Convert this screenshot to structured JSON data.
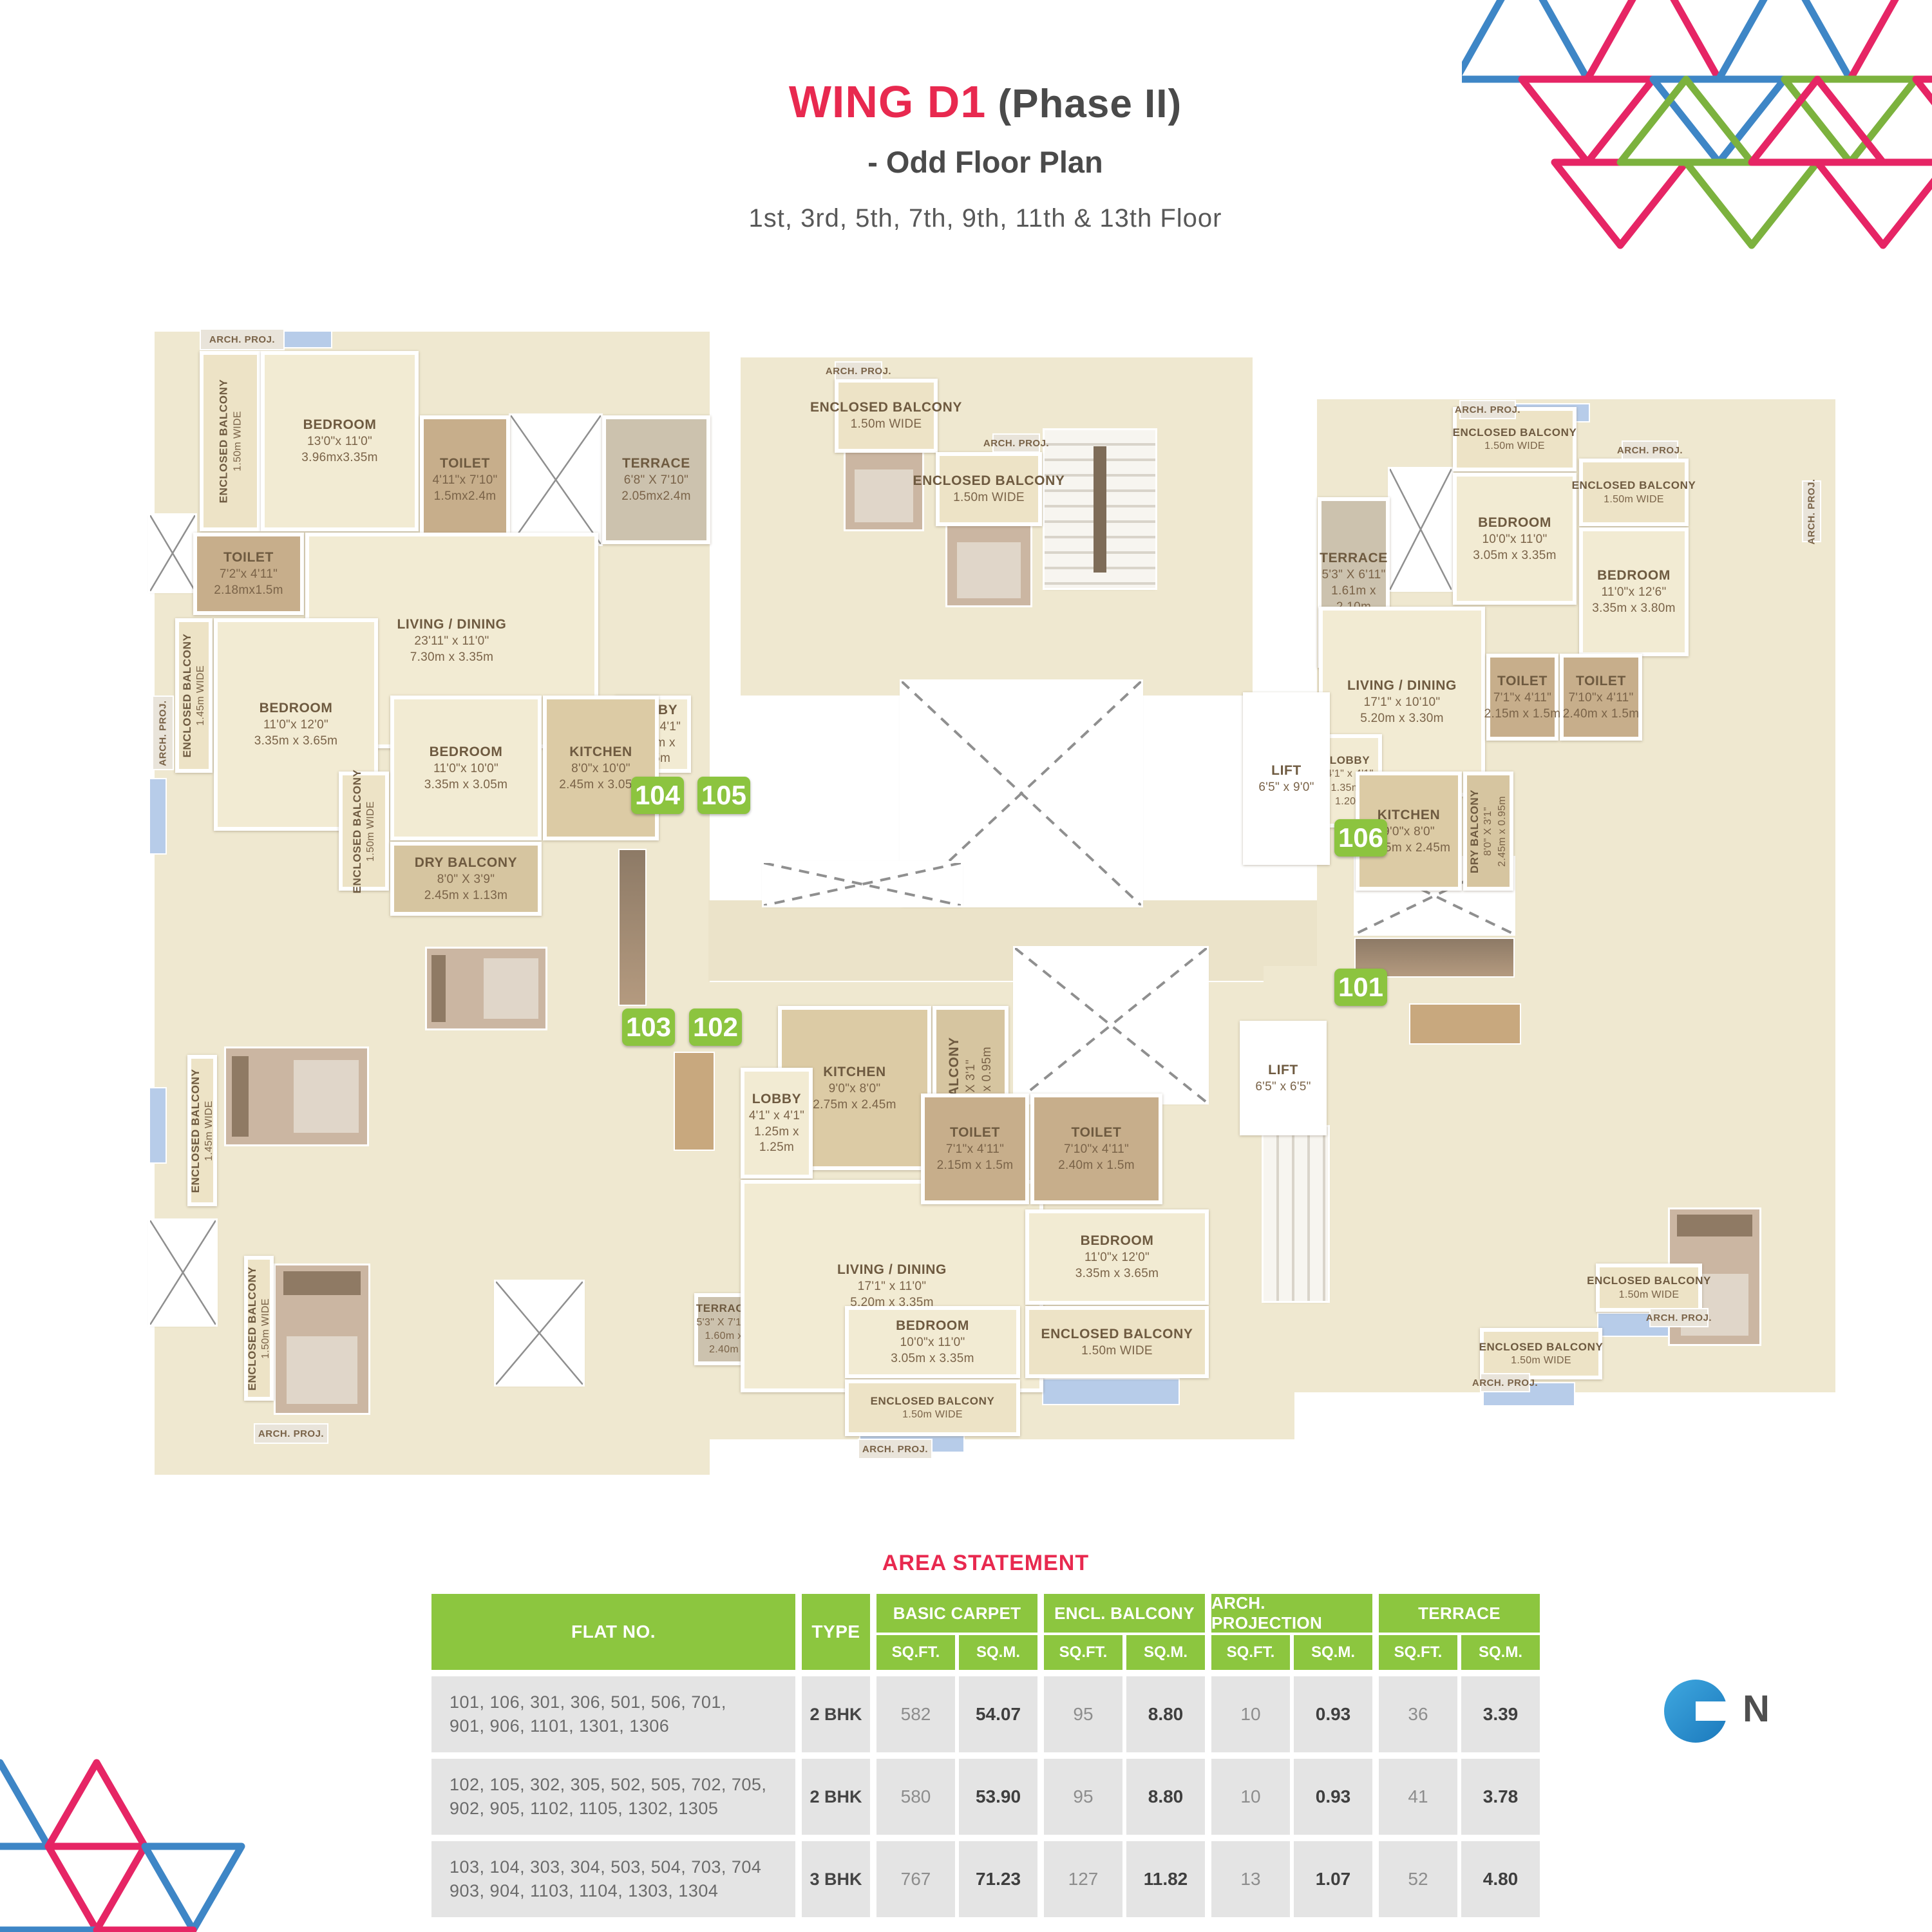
{
  "header": {
    "title_main": "WING D1",
    "title_suffix": " (Phase II)",
    "subtitle": "-  Odd Floor Plan",
    "floors": "1st, 3rd, 5th, 7th, 9th, 11th & 13th Floor"
  },
  "plan": {
    "passage_label": "5'5\" WIDE PASSAGE",
    "arch_proj_label": "ARCH. PROJ.",
    "flat_badges": [
      "104",
      "105",
      "103",
      "102",
      "106",
      "101"
    ],
    "rooms": [
      {
        "id": "eb-104a",
        "lines": [
          "ENCLOSED BALCONY",
          "1.50m WIDE"
        ]
      },
      {
        "id": "bed-104a",
        "lines": [
          "BEDROOM",
          "13'0\"x 11'0\"",
          "3.96mx3.35m"
        ]
      },
      {
        "id": "wc-104a",
        "lines": [
          "TOILET",
          "4'11\"x 7'10\"",
          "1.5mx2.4m"
        ]
      },
      {
        "id": "ter-104",
        "lines": [
          "TERRACE",
          "6'8\" X 7'10\"",
          "2.05mx2.4m"
        ]
      },
      {
        "id": "wc-104b",
        "lines": [
          "TOILET",
          "7'2\"x 4'11\"",
          "2.18mx1.5m"
        ]
      },
      {
        "id": "liv-104",
        "lines": [
          "LIVING / DINING",
          "23'11\" x 11'0\"",
          "7.30m x 3.35m"
        ]
      },
      {
        "id": "eb-104b",
        "lines": [
          "ENCLOSED BALCONY",
          "1.45m WIDE"
        ]
      },
      {
        "id": "bed-104b",
        "lines": [
          "BEDROOM",
          "11'0\"x 12'0\"",
          "3.35m x 3.65m"
        ]
      },
      {
        "id": "lobby-104",
        "lines": [
          "LOBBY",
          "4'1\" x 4'1\"",
          "1.25m x",
          "1.25m"
        ]
      },
      {
        "id": "bed-104c",
        "lines": [
          "BEDROOM",
          "11'0\"x 10'0\"",
          "3.35m x 3.05m"
        ]
      },
      {
        "id": "kit-104",
        "lines": [
          "KITCHEN",
          "8'0\"x 10'0\"",
          "2.45m x 3.05m"
        ]
      },
      {
        "id": "eb-104c",
        "lines": [
          "ENCLOSED BALCONY",
          "1.50m WIDE"
        ]
      },
      {
        "id": "dry-104",
        "lines": [
          "DRY BALCONY",
          "8'0\" X 3'9\"",
          "2.45m x 1.13m"
        ]
      },
      {
        "id": "eb-103a",
        "lines": [
          "ENCLOSED BALCONY",
          "1.45m WIDE"
        ]
      },
      {
        "id": "eb-103b",
        "lines": [
          "ENCLOSED BALCONY",
          "1.50m WIDE"
        ]
      },
      {
        "id": "ter-103",
        "lines": [
          "TERRACE",
          "5'3\" X 7'10\"",
          "1.60m x",
          "2.40m"
        ]
      },
      {
        "id": "kit-102",
        "lines": [
          "KITCHEN",
          "9'0\"x 8'0\"",
          "2.75m x 2.45m"
        ]
      },
      {
        "id": "dry-102",
        "lines": [
          "DRY BALCONY",
          "8'0\" X 3'1\"",
          "2.45m x 0.95m"
        ]
      },
      {
        "id": "lobby-102",
        "lines": [
          "LOBBY",
          "4'1\" x 4'1\"",
          "1.25m x",
          "1.25m"
        ]
      },
      {
        "id": "liv-102",
        "lines": [
          "LIVING / DINING",
          "17'1\" x 11'0\"",
          "5.20m x 3.35m"
        ]
      },
      {
        "id": "wc-102a",
        "lines": [
          "TOILET",
          "7'1\"x 4'11\"",
          "2.15m x 1.5m"
        ]
      },
      {
        "id": "wc-102b",
        "lines": [
          "TOILET",
          "7'10\"x 4'11\"",
          "2.40m x 1.5m"
        ]
      },
      {
        "id": "bed-102a",
        "lines": [
          "BEDROOM",
          "11'0\"x 12'0\"",
          "3.35m x 3.65m"
        ]
      },
      {
        "id": "eb-102a",
        "lines": [
          "ENCLOSED BALCONY",
          "1.50m WIDE"
        ]
      },
      {
        "id": "bed-102b",
        "lines": [
          "BEDROOM",
          "10'0\"x 11'0\"",
          "3.05m x 3.35m"
        ]
      },
      {
        "id": "eb-102b",
        "lines": [
          "ENCLOSED BALCONY",
          "1.50m WIDE"
        ]
      },
      {
        "id": "eb-105a",
        "lines": [
          "ENCLOSED BALCONY",
          "1.50m WIDE"
        ]
      },
      {
        "id": "eb-105b",
        "lines": [
          "ENCLOSED BALCONY",
          "1.50m WIDE"
        ]
      },
      {
        "id": "ter-101",
        "lines": [
          "TERRACE",
          "5'3\" X 6'11\"",
          "1.61m x",
          "2.10m"
        ]
      },
      {
        "id": "eb-106a",
        "lines": [
          "ENCLOSED BALCONY",
          "1.50m WIDE"
        ]
      },
      {
        "id": "bed-106a",
        "lines": [
          "BEDROOM",
          "10'0\"x 11'0\"",
          "3.05m x 3.35m"
        ]
      },
      {
        "id": "eb-106b",
        "lines": [
          "ENCLOSED BALCONY",
          "1.50m WIDE"
        ]
      },
      {
        "id": "bed-106b",
        "lines": [
          "BEDROOM",
          "11'0\"x 12'6\"",
          "3.35m x 3.80m"
        ]
      },
      {
        "id": "liv-101",
        "lines": [
          "LIVING / DINING",
          "17'1\" x 10'10\"",
          "5.20m x 3.30m"
        ]
      },
      {
        "id": "wc-101a",
        "lines": [
          "TOILET",
          "7'1\"x 4'11\"",
          "2.15m x 1.5m"
        ]
      },
      {
        "id": "wc-101b",
        "lines": [
          "TOILET",
          "7'10\"x 4'11\"",
          "2.40m x 1.5m"
        ]
      },
      {
        "id": "lobby-101",
        "lines": [
          "LOBBY",
          "4'1\" x 4'1\"",
          "1.35m x",
          "1.20m"
        ]
      },
      {
        "id": "kit-101",
        "lines": [
          "KITCHEN",
          "9'0\"x 8'0\"",
          "2.75m x 2.45m"
        ]
      },
      {
        "id": "dry-101",
        "lines": [
          "DRY BALCONY",
          "8'0\" X 3'1\"",
          "2.45m x 0.95m"
        ]
      },
      {
        "id": "eb-101a",
        "lines": [
          "ENCLOSED BALCONY",
          "1.50m WIDE"
        ]
      },
      {
        "id": "eb-101b",
        "lines": [
          "ENCLOSED BALCONY",
          "1.50m WIDE"
        ]
      },
      {
        "id": "lift-1",
        "lines": [
          "LIFT",
          "6'5\" x 9'0\""
        ]
      },
      {
        "id": "lift-2",
        "lines": [
          "LIFT",
          "6'5\" x 6'5\""
        ]
      }
    ]
  },
  "north": {
    "label": "N"
  },
  "table": {
    "title": "AREA STATEMENT",
    "col_flat": "FLAT NO.",
    "col_type": "TYPE",
    "sub_sqft": "SQ.FT.",
    "sub_sqm": "SQ.M.",
    "groups": [
      {
        "label": "BASIC CARPET"
      },
      {
        "label": "ENCL. BALCONY"
      },
      {
        "label": "ARCH. PROJECTION"
      },
      {
        "label": "TERRACE"
      }
    ],
    "rows": [
      {
        "flats": [
          "101, 106, 301, 306, 501, 506, 701,",
          "901, 906, 1101, 1301, 1306"
        ],
        "type": "2 BHK",
        "values": [
          "582",
          "54.07",
          "95",
          "8.80",
          "10",
          "0.93",
          "36",
          "3.39"
        ]
      },
      {
        "flats": [
          "102, 105, 302, 305, 502, 505, 702, 705,",
          "902, 905, 1102, 1105, 1302, 1305"
        ],
        "type": "2 BHK",
        "values": [
          "580",
          "53.90",
          "95",
          "8.80",
          "10",
          "0.93",
          "41",
          "3.78"
        ]
      },
      {
        "flats": [
          "103, 104, 303, 304, 503, 504, 703, 704",
          "903, 904, 1103, 1104, 1303, 1304"
        ],
        "type": "3 BHK",
        "values": [
          "767",
          "71.23",
          "127",
          "11.82",
          "13",
          "1.07",
          "52",
          "4.80"
        ]
      }
    ]
  },
  "colors": {
    "title_red": "#E8294F",
    "badge_green": "#8CC43F",
    "table_green": "#8CC63F",
    "north_blue": "#2E9BD6",
    "tri_pink": "#E62565",
    "tri_blue": "#3E86C6",
    "tri_green": "#7CB23E"
  }
}
